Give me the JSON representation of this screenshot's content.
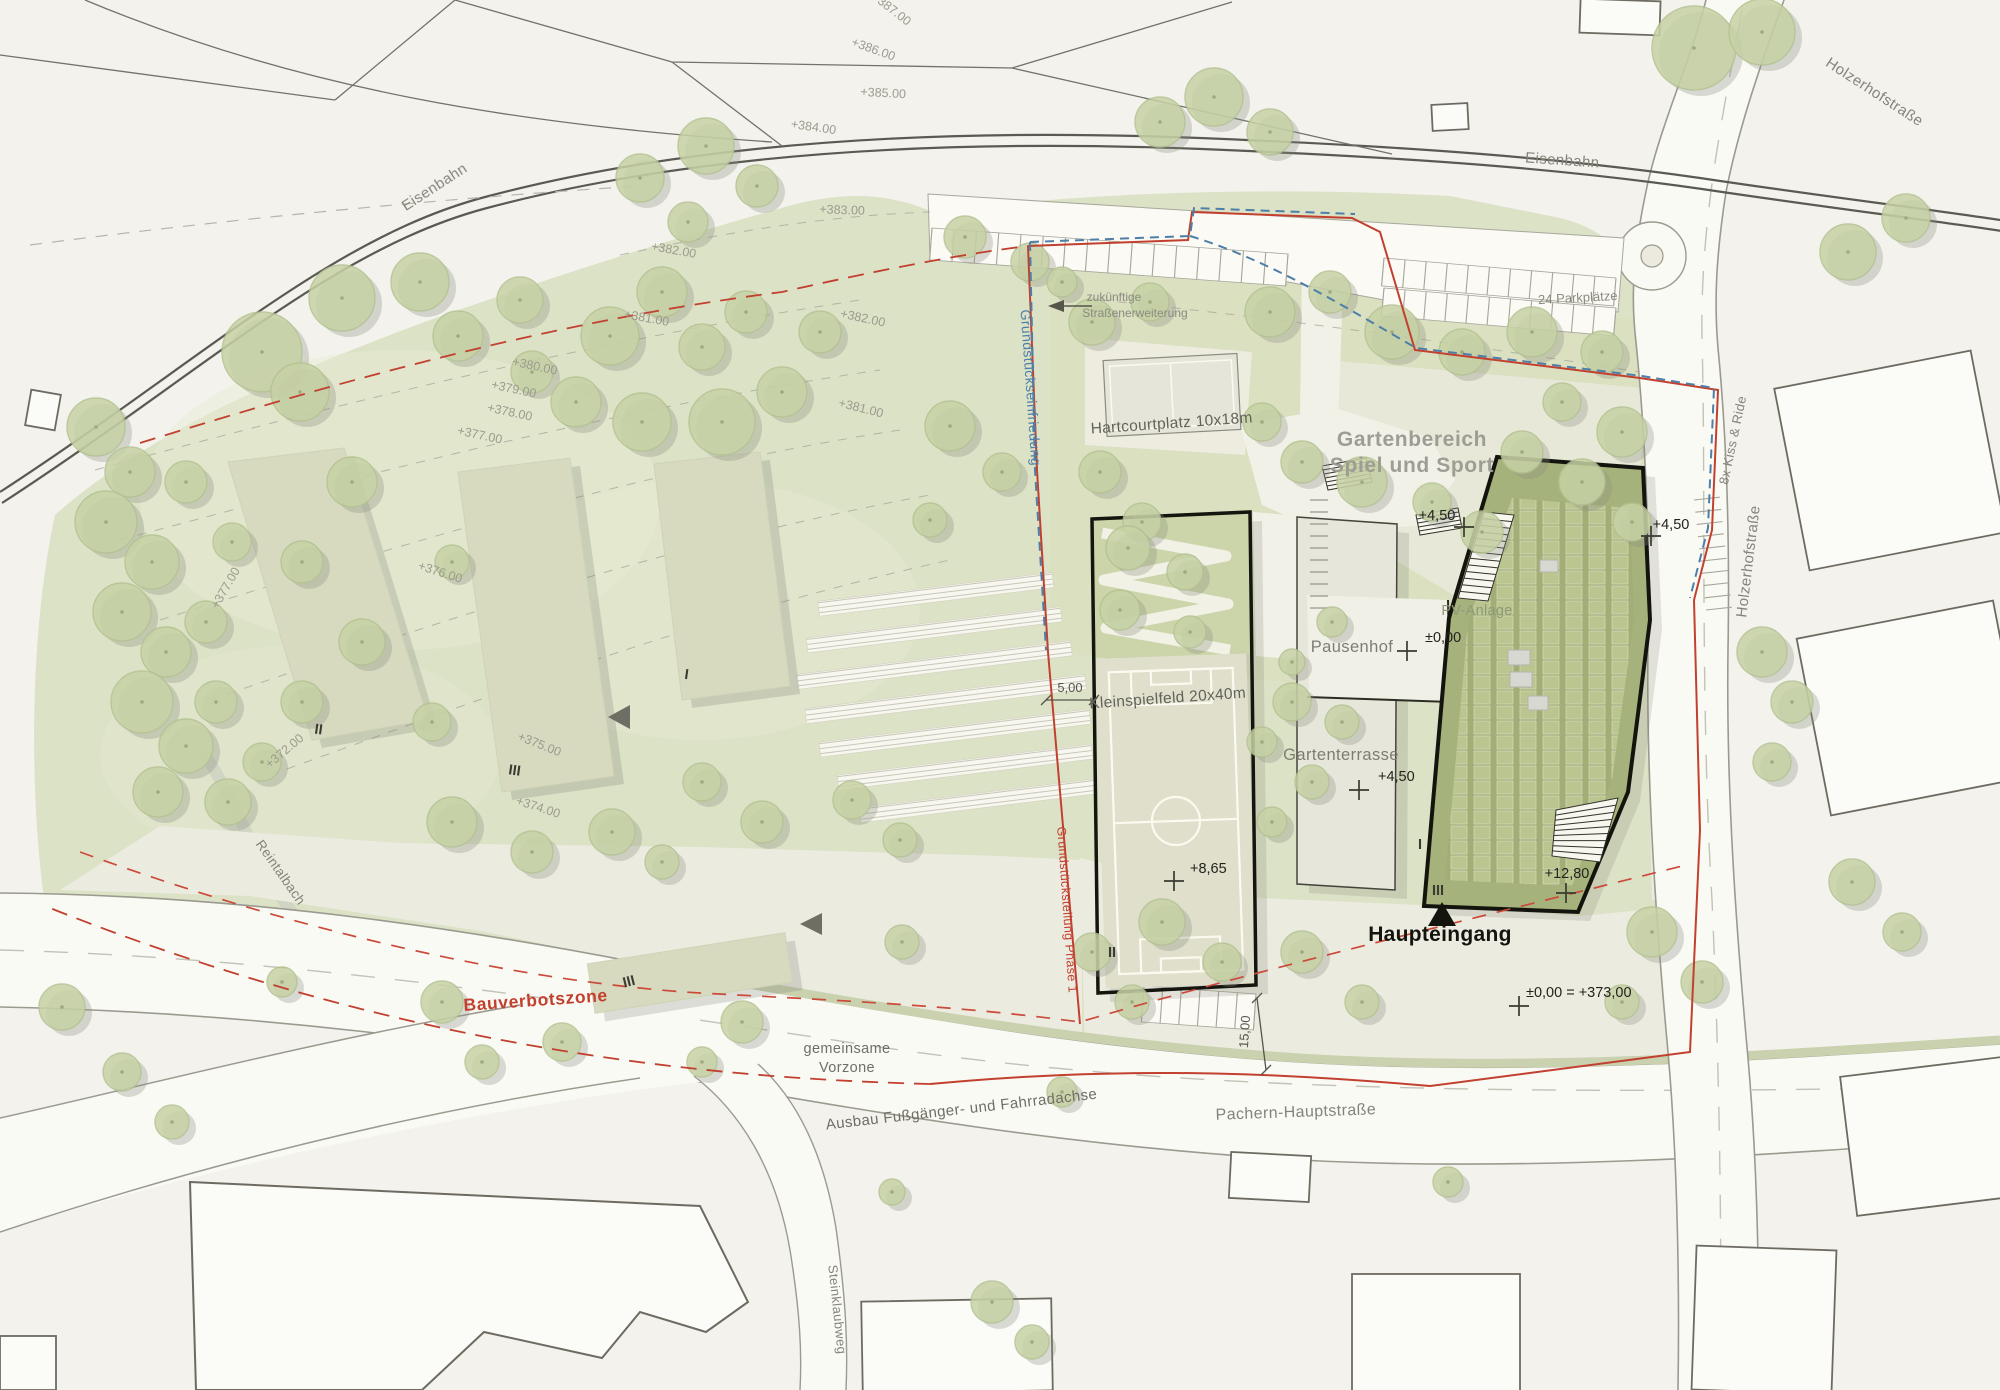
{
  "colors": {
    "paper": "#f3f2ec",
    "meadow": "#dce2c6",
    "garden": "#d9e0bf",
    "tree": "#c7d2a5",
    "road": "#fafaf5",
    "pavement": "#ecebe0",
    "building_light": "#d7dabf",
    "roof_pv": "#a6b27b",
    "sports_field": "#e0dfcb",
    "boundary_red": "#c2402f",
    "fence_blue": "#4e7fa8",
    "outline_dark": "#15150f",
    "text_grey": "#8f8f83"
  },
  "streets": {
    "eisenbahn_nw": "Eisenbahn",
    "eisenbahn_ne": "Eisenbahn",
    "holzerhof_top": "Holzerhofstraße",
    "holzerhof_east": "Holzerhofstraße",
    "kiss_ride": "8x Kiss & Ride",
    "pachern": "Pachern-Hauptstraße",
    "ausbau": "Ausbau Fußgänger- und Fahrradachse",
    "steinklaubweg": "Steinklaubweg",
    "reintalbach": "Reintalbach"
  },
  "site": {
    "hartcourt": "Hartcourtplatz 10x18m",
    "gartenbereich_line1": "Gartenbereich",
    "gartenbereich_line2": "Spiel und Sport",
    "pausenhof": "Pausenhof",
    "gartenterrasse": "Gartenterrasse",
    "kleinspielfeld": "Kleinspielfeld 20x40m",
    "pv": "PV-Anlage",
    "haupteingang": "Haupteingang",
    "parkplaetze": "24 Parkplätze",
    "vorzone_line1": "gemeinsame",
    "vorzone_line2": "Vorzone",
    "zukuenftig_line1": "zukünftige",
    "zukuenftig_line2": "Straßenerweiterung",
    "bauverbotszone": "Bauverbotszone",
    "einfriedung": "Grundstückseinfriedung",
    "teilung": "Grundstücksteilung Phase 1"
  },
  "markers": [
    {
      "t": "+4,50",
      "lx": 1437,
      "ly": 520,
      "anchor": "middle",
      "cx": 1464,
      "cy": 527
    },
    {
      "t": "+4,50",
      "lx": 1671,
      "ly": 529,
      "anchor": "middle",
      "cx": 1651,
      "cy": 536
    },
    {
      "t": "±0,00",
      "lx": 1425,
      "ly": 642,
      "anchor": "start",
      "cx": 1407,
      "cy": 651
    },
    {
      "t": "+4,50",
      "lx": 1378,
      "ly": 781,
      "anchor": "start",
      "cx": 1359,
      "cy": 790
    },
    {
      "t": "+8,65",
      "lx": 1190,
      "ly": 873,
      "anchor": "start",
      "cx": 1174,
      "cy": 881
    },
    {
      "t": "+12,80",
      "lx": 1567,
      "ly": 878,
      "anchor": "middle",
      "cx": 1566,
      "cy": 893
    },
    {
      "t": "±0,00 = +373,00",
      "lx": 1526,
      "ly": 997,
      "anchor": "start",
      "cx": 1519,
      "cy": 1006
    }
  ],
  "storeys": [
    {
      "t": "II",
      "x": 318,
      "y": 734,
      "r": 8
    },
    {
      "t": "III",
      "x": 514,
      "y": 775,
      "r": 8
    },
    {
      "t": "I",
      "x": 686,
      "y": 679,
      "r": 8
    },
    {
      "t": "III",
      "x": 630,
      "y": 986,
      "r": -14
    },
    {
      "t": "II",
      "x": 1112,
      "y": 957,
      "r": 0
    },
    {
      "t": "I",
      "x": 1420,
      "y": 849,
      "r": 0
    },
    {
      "t": "III",
      "x": 1438,
      "y": 895,
      "r": 0
    }
  ],
  "contours": [
    {
      "t": "+387.00",
      "x": 889,
      "y": 12,
      "r": 38
    },
    {
      "t": "+386.00",
      "x": 872,
      "y": 53,
      "r": 20
    },
    {
      "t": "+385.00",
      "x": 883,
      "y": 97,
      "r": 3
    },
    {
      "t": "+384.00",
      "x": 813,
      "y": 131,
      "r": 8
    },
    {
      "t": "+383.00",
      "x": 842,
      "y": 214,
      "r": 2
    },
    {
      "t": "+382.00",
      "x": 673,
      "y": 254,
      "r": 10
    },
    {
      "t": "+382.00",
      "x": 862,
      "y": 322,
      "r": 12
    },
    {
      "t": "+381.00",
      "x": 646,
      "y": 322,
      "r": 10
    },
    {
      "t": "+381.00",
      "x": 860,
      "y": 412,
      "r": 14
    },
    {
      "t": "+380.00",
      "x": 534,
      "y": 370,
      "r": 12
    },
    {
      "t": "+379.00",
      "x": 513,
      "y": 393,
      "r": 12
    },
    {
      "t": "+378.00",
      "x": 509,
      "y": 416,
      "r": 12
    },
    {
      "t": "+377.00",
      "x": 479,
      "y": 439,
      "r": 12
    },
    {
      "t": "+377.00",
      "x": 229,
      "y": 590,
      "r": -60
    },
    {
      "t": "+376.00",
      "x": 439,
      "y": 576,
      "r": 18
    },
    {
      "t": "+375.00",
      "x": 538,
      "y": 748,
      "r": 22
    },
    {
      "t": "+374.00",
      "x": 537,
      "y": 811,
      "r": 18
    },
    {
      "t": "+372.00",
      "x": 287,
      "y": 754,
      "r": -40
    }
  ],
  "dimensions": [
    {
      "t": "5,00",
      "lx": 1070,
      "ly": 692,
      "r": 0,
      "x1": 1046,
      "y1": 700,
      "x2": 1094,
      "y2": 700
    },
    {
      "t": "15,00",
      "lx": 1249,
      "ly": 1032,
      "r": -86,
      "x1": 1257,
      "y1": 998,
      "x2": 1266,
      "y2": 1070
    }
  ],
  "parking": {
    "rows": [
      {
        "x1": 932,
        "y1": 228,
        "x2": 1288,
        "y2": 254,
        "n": 16,
        "depth": 32,
        "band": true
      },
      {
        "x1": 1384,
        "y1": 258,
        "x2": 1616,
        "y2": 278,
        "n": 11,
        "depth": 28,
        "band": true
      },
      {
        "x1": 1384,
        "y1": 288,
        "x2": 1616,
        "y2": 308,
        "n": 11,
        "depth": 28,
        "band": true
      },
      {
        "x1": 1144,
        "y1": 986,
        "x2": 1256,
        "y2": 994,
        "n": 6,
        "depth": 36,
        "band": true
      },
      {
        "x1": 1694,
        "y1": 500,
        "x2": 1706,
        "y2": 610,
        "n": 9,
        "depth": -26,
        "band": false
      }
    ]
  },
  "scenery": {
    "trees": [
      [
        262,
        352,
        40
      ],
      [
        342,
        298,
        33
      ],
      [
        300,
        392,
        29
      ],
      [
        420,
        282,
        29
      ],
      [
        458,
        336,
        25
      ],
      [
        520,
        300,
        23
      ],
      [
        610,
        336,
        29
      ],
      [
        662,
        292,
        25
      ],
      [
        702,
        347,
        23
      ],
      [
        746,
        312,
        21
      ],
      [
        532,
        372,
        21
      ],
      [
        576,
        402,
        25
      ],
      [
        642,
        422,
        29
      ],
      [
        722,
        422,
        33
      ],
      [
        782,
        392,
        25
      ],
      [
        820,
        332,
        21
      ],
      [
        640,
        178,
        24
      ],
      [
        706,
        146,
        28
      ],
      [
        757,
        186,
        21
      ],
      [
        688,
        222,
        20
      ],
      [
        1160,
        122,
        25
      ],
      [
        1214,
        97,
        29
      ],
      [
        1270,
        132,
        23
      ],
      [
        965,
        237,
        21
      ],
      [
        1030,
        262,
        19
      ],
      [
        1062,
        282,
        15
      ],
      [
        1694,
        48,
        42
      ],
      [
        1762,
        32,
        33
      ],
      [
        1848,
        252,
        28
      ],
      [
        1906,
        218,
        24
      ],
      [
        96,
        427,
        29
      ],
      [
        130,
        472,
        25
      ],
      [
        106,
        522,
        31
      ],
      [
        152,
        562,
        27
      ],
      [
        122,
        612,
        29
      ],
      [
        166,
        652,
        25
      ],
      [
        142,
        702,
        31
      ],
      [
        186,
        746,
        27
      ],
      [
        158,
        792,
        25
      ],
      [
        216,
        702,
        21
      ],
      [
        206,
        622,
        21
      ],
      [
        232,
        542,
        19
      ],
      [
        186,
        482,
        21
      ],
      [
        228,
        802,
        23
      ],
      [
        262,
        762,
        19
      ],
      [
        352,
        482,
        25
      ],
      [
        302,
        562,
        21
      ],
      [
        362,
        642,
        23
      ],
      [
        302,
        702,
        21
      ],
      [
        432,
        722,
        19
      ],
      [
        452,
        562,
        17
      ],
      [
        452,
        822,
        25
      ],
      [
        532,
        852,
        21
      ],
      [
        612,
        832,
        23
      ],
      [
        702,
        782,
        19
      ],
      [
        762,
        822,
        21
      ],
      [
        662,
        862,
        17
      ],
      [
        852,
        800,
        19
      ],
      [
        900,
        840,
        17
      ],
      [
        950,
        426,
        25
      ],
      [
        1002,
        472,
        19
      ],
      [
        930,
        520,
        17
      ],
      [
        1092,
        322,
        23
      ],
      [
        1150,
        302,
        19
      ],
      [
        1270,
        312,
        25
      ],
      [
        1330,
        292,
        21
      ],
      [
        1392,
        332,
        27
      ],
      [
        1462,
        352,
        23
      ],
      [
        1532,
        332,
        25
      ],
      [
        1602,
        352,
        21
      ],
      [
        1562,
        402,
        19
      ],
      [
        1622,
        432,
        25
      ],
      [
        1522,
        452,
        21
      ],
      [
        1262,
        422,
        19
      ],
      [
        1302,
        462,
        21
      ],
      [
        1362,
        482,
        25
      ],
      [
        1432,
        502,
        19
      ],
      [
        1482,
        532,
        21
      ],
      [
        1582,
        482,
        23
      ],
      [
        1632,
        522,
        19
      ],
      [
        1100,
        472,
        21
      ],
      [
        1142,
        522,
        19
      ],
      [
        1128,
        548,
        22
      ],
      [
        1185,
        572,
        18
      ],
      [
        1120,
        610,
        20
      ],
      [
        1190,
        632,
        16
      ],
      [
        1332,
        622,
        15
      ],
      [
        1292,
        662,
        13
      ],
      [
        1292,
        702,
        19
      ],
      [
        1342,
        722,
        17
      ],
      [
        1262,
        742,
        15
      ],
      [
        1312,
        782,
        17
      ],
      [
        1272,
        822,
        15
      ],
      [
        1162,
        922,
        23
      ],
      [
        1222,
        962,
        19
      ],
      [
        1302,
        952,
        21
      ],
      [
        1132,
        1002,
        17
      ],
      [
        1092,
        952,
        19
      ],
      [
        1362,
        1002,
        17
      ],
      [
        1652,
        932,
        25
      ],
      [
        1702,
        982,
        21
      ],
      [
        1622,
        1002,
        17
      ],
      [
        442,
        1002,
        21
      ],
      [
        482,
        1062,
        17
      ],
      [
        562,
        1042,
        19
      ],
      [
        742,
        1022,
        21
      ],
      [
        702,
        1062,
        15
      ],
      [
        902,
        942,
        17
      ],
      [
        1062,
        1092,
        15
      ],
      [
        1762,
        652,
        25
      ],
      [
        1792,
        702,
        21
      ],
      [
        1772,
        762,
        19
      ],
      [
        1852,
        882,
        23
      ],
      [
        1902,
        932,
        19
      ],
      [
        992,
        1302,
        21
      ],
      [
        1032,
        1342,
        17
      ],
      [
        62,
        1007,
        23
      ],
      [
        122,
        1072,
        19
      ],
      [
        172,
        1122,
        17
      ],
      [
        1448,
        1182,
        15
      ],
      [
        892,
        1192,
        13
      ],
      [
        282,
        982,
        15
      ]
    ]
  }
}
